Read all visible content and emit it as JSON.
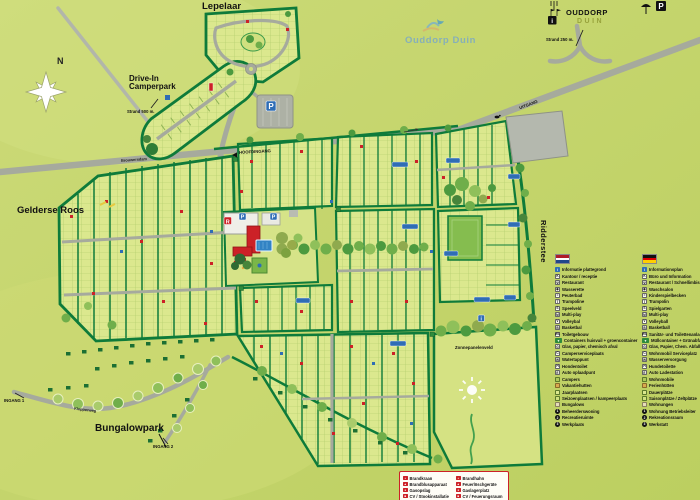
{
  "brand": {
    "watermark": "Ouddorp Duin",
    "name_top": "OUDDORP",
    "name_bottom": "DUIN"
  },
  "compass_n": "N",
  "areas": {
    "lepelaar": "Lepelaar",
    "camperpark": "Drive-In\nCamperpark",
    "gelderse_roos": "Gelderse Roos",
    "ridderstee": "Ridderstee",
    "bungalowpark": "Bungalowpark",
    "zonnepanelenveld": "Zonnepanelenveld"
  },
  "entrances": {
    "main": "HOOFDINGANG",
    "exit": "UITGANG",
    "entrance1": "INGANG 1",
    "entrance2": "INGANG 2"
  },
  "streets": {
    "brouwersdam": "Brouwersdam",
    "klepperweg": "Klepperweg"
  },
  "distances": {
    "beach_250": "Strand 250 m.",
    "beach_500": "Strand 500 m."
  },
  "icons": {
    "parking_glyph": "P",
    "reception_glyph": "R",
    "info_glyph": "i"
  },
  "colors": {
    "background": "#c9d771",
    "plot_fill": "#dbe88e",
    "hedge_green": "#0e7b3a",
    "road_gray": "#a6aa9d",
    "accent_red": "#cc2127",
    "accent_blue": "#2f6db5"
  },
  "legend_nl": {
    "items": [
      {
        "glyph": "i",
        "cls": "blue",
        "label": "Informatie plattegrond",
        "icon": "info-icon"
      },
      {
        "glyph": "K",
        "cls": "white",
        "label": "Kantoor / receptie",
        "icon": "reception-icon"
      },
      {
        "glyph": "Ψ",
        "cls": "white",
        "label": "Restaurant",
        "icon": "restaurant-icon"
      },
      {
        "glyph": "◉",
        "cls": "white",
        "label": "Wasserette",
        "icon": "laundry-icon"
      },
      {
        "glyph": "≈",
        "cls": "white",
        "label": "Peuterbad",
        "icon": "toddler-pool-icon"
      },
      {
        "glyph": "T",
        "cls": "white",
        "label": "Trampoline",
        "icon": "trampoline-icon"
      },
      {
        "glyph": "S",
        "cls": "white",
        "label": "Speelveld",
        "icon": "playfield-icon"
      },
      {
        "glyph": "M",
        "cls": "white",
        "label": "Multi-play",
        "icon": "multiplay-icon"
      },
      {
        "glyph": "V",
        "cls": "white",
        "label": "Volleybal",
        "icon": "volleyball-icon"
      },
      {
        "glyph": "B",
        "cls": "white",
        "label": "Basketbal",
        "icon": "basketball-icon"
      },
      {
        "glyph": "WC",
        "cls": "white",
        "label": "Toiletgebouw",
        "icon": "toilet-building-icon"
      },
      {
        "glyph": "▼",
        "cls": "green",
        "label": "Containers huisvuil + groencontainer",
        "icon": "waste-container-icon"
      },
      {
        "glyph": "G",
        "cls": "white",
        "label": "Glas, papier, chemisch afval",
        "icon": "glass-paper-icon"
      },
      {
        "glyph": "C",
        "cls": "white",
        "label": "Camperserviceplaats",
        "icon": "camper-service-icon"
      },
      {
        "glyph": "W",
        "cls": "white",
        "label": "Watertappunt",
        "icon": "water-tap-icon"
      },
      {
        "glyph": "H",
        "cls": "white",
        "label": "Hondentoilet",
        "icon": "dog-toilet-icon"
      },
      {
        "glyph": "E",
        "cls": "white",
        "label": "Auto oplaadpunt",
        "icon": "car-charging-icon"
      },
      {
        "glyph": "",
        "cls": "olive",
        "label": "Campers",
        "icon": "campers-area-icon"
      },
      {
        "glyph": "",
        "cls": "tan",
        "label": "Vakantiehutten",
        "icon": "holiday-cabins-area-icon"
      },
      {
        "glyph": "",
        "cls": "plot",
        "label": "Jaarplaatsen",
        "icon": "annual-pitches-area-icon"
      },
      {
        "glyph": "",
        "cls": "plot2",
        "label": "Seizoenplaatsen / kampeerplaats",
        "icon": "seasonal-pitches-area-icon"
      },
      {
        "glyph": "",
        "cls": "beige",
        "label": "Bungalows",
        "icon": "bungalows-area-icon"
      },
      {
        "glyph": "1",
        "cls": "dark",
        "label": "Beheerderswoning",
        "icon": "manager-house-icon"
      },
      {
        "glyph": "2",
        "cls": "dark",
        "label": "Recreatieruimte",
        "icon": "recreation-room-icon"
      },
      {
        "glyph": "3",
        "cls": "dark",
        "label": "Werkplaats",
        "icon": "workshop-icon"
      }
    ]
  },
  "legend_de": {
    "items": [
      {
        "glyph": "i",
        "cls": "blue",
        "label": "Informationsplan",
        "icon": "info-icon"
      },
      {
        "glyph": "K",
        "cls": "white",
        "label": "Büro und Information",
        "icon": "reception-icon"
      },
      {
        "glyph": "Ψ",
        "cls": "white",
        "label": "Restaurant / Schnellimbiss",
        "icon": "restaurant-icon"
      },
      {
        "glyph": "◉",
        "cls": "white",
        "label": "Waschsalon",
        "icon": "laundry-icon"
      },
      {
        "glyph": "≈",
        "cls": "white",
        "label": "Kinderspielbecken",
        "icon": "toddler-pool-icon"
      },
      {
        "glyph": "T",
        "cls": "white",
        "label": "Trampolin",
        "icon": "trampoline-icon"
      },
      {
        "glyph": "S",
        "cls": "white",
        "label": "Spielgarten",
        "icon": "playfield-icon"
      },
      {
        "glyph": "M",
        "cls": "white",
        "label": "Multi-play",
        "icon": "multiplay-icon"
      },
      {
        "glyph": "V",
        "cls": "white",
        "label": "Volleyball",
        "icon": "volleyball-icon"
      },
      {
        "glyph": "B",
        "cls": "white",
        "label": "Basketball",
        "icon": "basketball-icon"
      },
      {
        "glyph": "WC",
        "cls": "white",
        "label": "Sanitär- und Toilettenanlage",
        "icon": "toilet-building-icon"
      },
      {
        "glyph": "▼",
        "cls": "green",
        "label": "Müllcontainer + Grünabfall",
        "icon": "waste-container-icon"
      },
      {
        "glyph": "G",
        "cls": "white",
        "label": "Glas, Papier, Chem. Abfall",
        "icon": "glass-paper-icon"
      },
      {
        "glyph": "C",
        "cls": "white",
        "label": "Wohnmobil Serviceplatz",
        "icon": "camper-service-icon"
      },
      {
        "glyph": "W",
        "cls": "white",
        "label": "Wasserversorgung",
        "icon": "water-tap-icon"
      },
      {
        "glyph": "H",
        "cls": "white",
        "label": "Hundetoilette",
        "icon": "dog-toilet-icon"
      },
      {
        "glyph": "E",
        "cls": "white",
        "label": "Auto Ladestation",
        "icon": "car-charging-icon"
      },
      {
        "glyph": "",
        "cls": "olive",
        "label": "Wohnmobile",
        "icon": "campers-area-icon"
      },
      {
        "glyph": "",
        "cls": "tan",
        "label": "Ferienhütten",
        "icon": "holiday-cabins-area-icon"
      },
      {
        "glyph": "",
        "cls": "plot",
        "label": "Dauerplätze",
        "icon": "annual-pitches-area-icon"
      },
      {
        "glyph": "",
        "cls": "plot2",
        "label": "Saisonplätze / Zeltplätze",
        "icon": "seasonal-pitches-area-icon"
      },
      {
        "glyph": "",
        "cls": "beige",
        "label": "Wohnungen",
        "icon": "bungalows-area-icon"
      },
      {
        "glyph": "1",
        "cls": "dark",
        "label": "Wohnung Betriebsleiter",
        "icon": "manager-house-icon"
      },
      {
        "glyph": "2",
        "cls": "dark",
        "label": "Rekreationsraum",
        "icon": "recreation-room-icon"
      },
      {
        "glyph": "3",
        "cls": "dark",
        "label": "Werkstatt",
        "icon": "workshop-icon"
      }
    ]
  },
  "fire_legend": {
    "nl": [
      {
        "glyph": "+",
        "label": "Brandkraan",
        "icon": "fire-hydrant-icon"
      },
      {
        "glyph": "▲",
        "label": "Brandblusapparaat",
        "icon": "fire-extinguisher-icon"
      },
      {
        "glyph": "●",
        "label": "Gasopslag",
        "icon": "gas-storage-icon"
      },
      {
        "glyph": "■",
        "label": "CV / Stookinstallatie",
        "icon": "heating-installation-icon"
      }
    ],
    "de": [
      {
        "glyph": "+",
        "label": "Brandhahn",
        "icon": "fire-hydrant-icon"
      },
      {
        "glyph": "▲",
        "label": "Feuerlöschgeräte",
        "icon": "fire-extinguisher-icon"
      },
      {
        "glyph": "●",
        "label": "Gaslagerplatz",
        "icon": "gas-storage-icon"
      },
      {
        "glyph": "■",
        "label": "CV / Feuerungsraum",
        "icon": "heating-installation-icon"
      }
    ]
  }
}
